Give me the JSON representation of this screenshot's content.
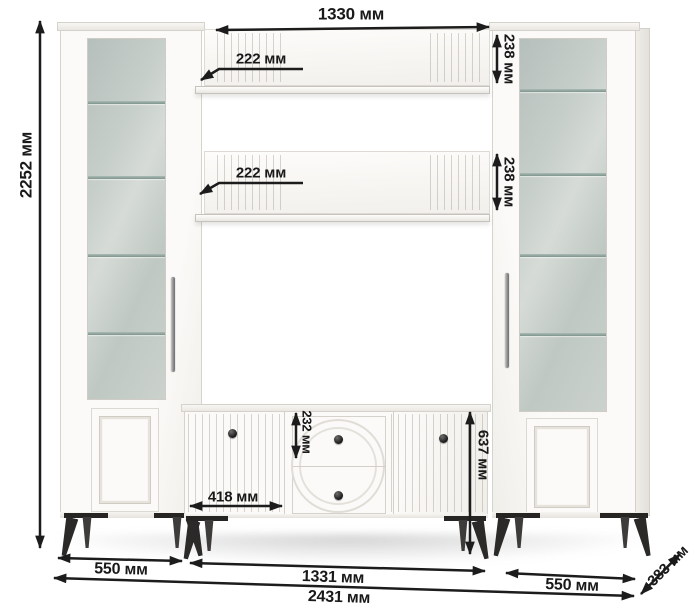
{
  "dims": {
    "shelf_length": "1330 мм",
    "shelf_depth_top": "222 мм",
    "shelf_depth_middle": "222 мм",
    "shelf_height_top": "238 мм",
    "shelf_height_middle": "238 мм",
    "total_height": "2252 мм",
    "drawer_height": "232 мм",
    "tvstand_door_width": "418 мм",
    "tvstand_height": "637 мм",
    "left_cabinet_width": "550 мм",
    "tvstand_width": "1331 мм",
    "right_cabinet_width": "550 мм",
    "total_width": "2431 мм",
    "unit_depth": "383 мм"
  }
}
